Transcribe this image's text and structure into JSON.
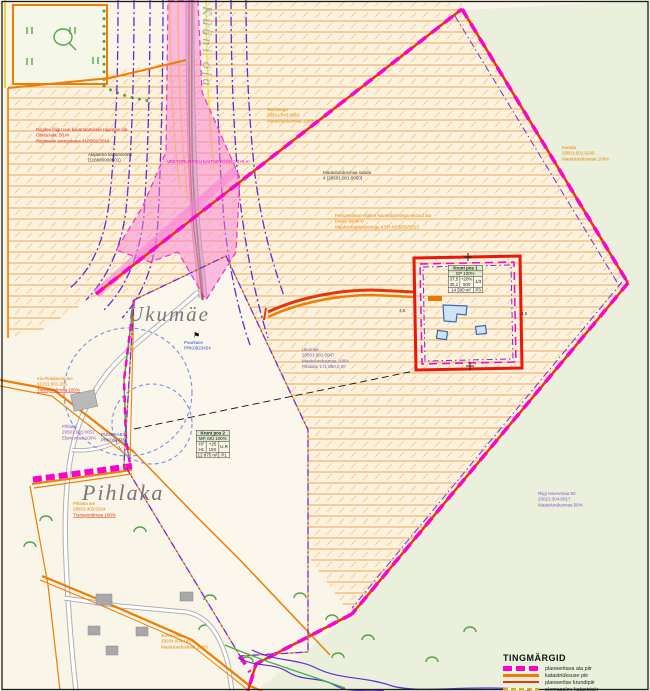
{
  "place_labels": {
    "ukumae": "Ukumäe",
    "pihlaka": "Pihlaka",
    "stream": "Küüni oja"
  },
  "annotations": {
    "restriction": {
      "l1": "Riigitee lõigu uue kavandamisele rajamise ala",
      "l2": "Ohutusala: 50 m",
      "l3": "Riigiteede arengukava 4105/02/2018"
    },
    "substation": {
      "l1": "Alajaama kaitsevöönd",
      "l2": "(118800000001)"
    },
    "tammeoja": {
      "l1": "Tammeoja",
      "l2": "28501:043:0063",
      "l3": "Maatulundusmaa 100%"
    },
    "kanala": {
      "l1": "Kanala",
      "l2": "29501:001:0245",
      "l3": "Maatulundusmaa 100%"
    },
    "center": {
      "l1": "Maatulundusmaa saada",
      "l2": "4 (29501:001:0050)"
    },
    "corridor": {
      "l1": "Perspektiivse riigitee kavandamisega seotud ala",
      "l2": "(trassi koridor)",
      "l3": "Maakonnaplaneeringu KSH 4105/03/2013"
    },
    "pipe": "VEETORUSTIKU KAITSEVÖÖND 2×5 m",
    "well": {
      "l1": "Puurkaev",
      "l2": "PRK0023454"
    },
    "ukumae_parcel": {
      "l1": "Ukumäe",
      "l2": "29501:001:0047",
      "l3": "Maatulundusmaa 100%",
      "l4": "Pindala: 171 860,0 m²"
    },
    "road": {
      "l1": "Kiu-Rutalause tee",
      "l2": "31201:001:205",
      "l3": "Transpordimaa 100%"
    },
    "pihlaka_parcel": {
      "l1": "Pihlaka",
      "l2": "29501:001:0051",
      "l3": "Elamumaa 100%"
    },
    "puurkaev": {
      "l1": "PUURKAEV",
      "l2": "PRK0012451"
    },
    "pihlaka_tee": {
      "l1": "Pihlaka tee",
      "l2": "29501:403:0104",
      "l3": "Transpordimaa 100%"
    },
    "jurtle": {
      "l1": "Jürtle-Niitu",
      "l2": "29204:004:1414",
      "l3": "Maatulundusmaa 100%"
    },
    "reserve": {
      "l1": "Riigi reservmaa 50",
      "l2": "20021:304:0017",
      "l3": "Maatulundusmaa 50%"
    },
    "dim_left": "4,5",
    "dim_right": "4,5"
  },
  "tables": {
    "pos1": {
      "title": "Krunt pos 1",
      "landuse": "EP 100%",
      "c1a": "37,5",
      "c1b": "35,1",
      "c2a": "+20%",
      "c2b": "500",
      "c3": "1/3",
      "area": "14 500 m²",
      "zone": "P3"
    },
    "pos2": {
      "title": "Krunt pos 2",
      "landuse": "MP, MÜ 100%",
      "c1a": "H7",
      "c1b": "H1",
      "c2a": "+25",
      "c2b": "15X",
      "c3": "U.R",
      "area": "12 875 m²",
      "zone": "P1"
    }
  },
  "legend": {
    "title": "TINGMÄRGID",
    "items": [
      {
        "label": "planeeritava ala piir"
      },
      {
        "label": "katastriüksuse piir"
      },
      {
        "label": "planeeritav krundipiir"
      },
      {
        "label": "olemasolev katastripiir"
      }
    ]
  },
  "colors": {
    "boundary_magenta": "#ff00cc",
    "cadastre_orange": "#ee7d00",
    "planned_red": "#e8340c",
    "utility_purple": "#5b2fd0",
    "water_blue": "#7b8fd9",
    "green_area": "#eaf0db",
    "hatch_orange": "#f0a55c",
    "corridor_pink": "#f77fd4"
  }
}
